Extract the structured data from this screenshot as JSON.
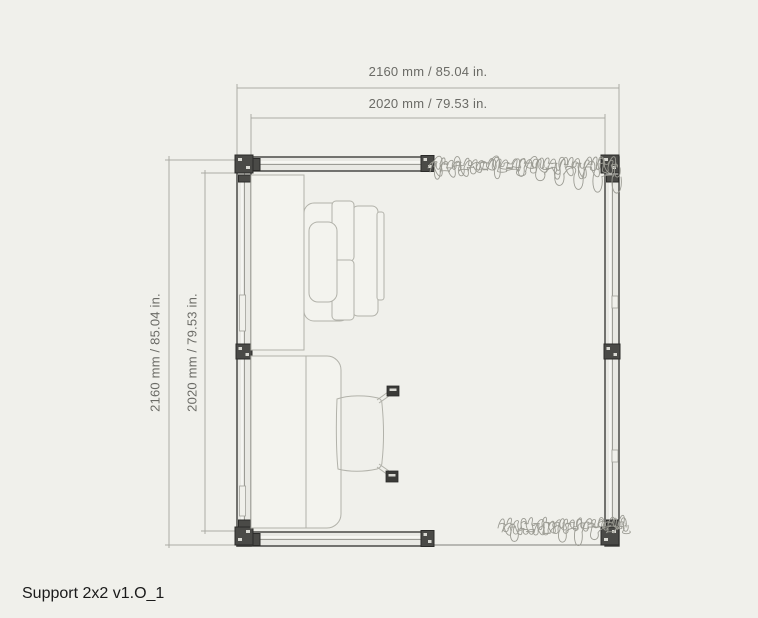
{
  "plan": {
    "title": "Support 2x2 v1.O_1",
    "dimensions": {
      "top_outer": "2160 mm / 85.04 in.",
      "top_inner": "2020 mm / 79.53 in.",
      "left_outer": "2160 mm / 85.04 in.",
      "left_inner": "2020 mm / 79.53 in."
    }
  },
  "colors": {
    "background": "#F0F0EB",
    "wall_line": "#3E3E3B",
    "wall_fill": "#E9E9E4",
    "wall_glass": "#9C9C96",
    "post_fill": "#4A4A47",
    "post_edge": "#2B2B29",
    "furniture_line": "#B2B2AA",
    "furniture_fill": "#F3F3EE",
    "dim_line": "#ABABA5",
    "dim_text": "#6B6B66",
    "plant_line": "#9B9B93",
    "edge_line": "#5A5A56",
    "title_text": "#1A1A1A"
  }
}
